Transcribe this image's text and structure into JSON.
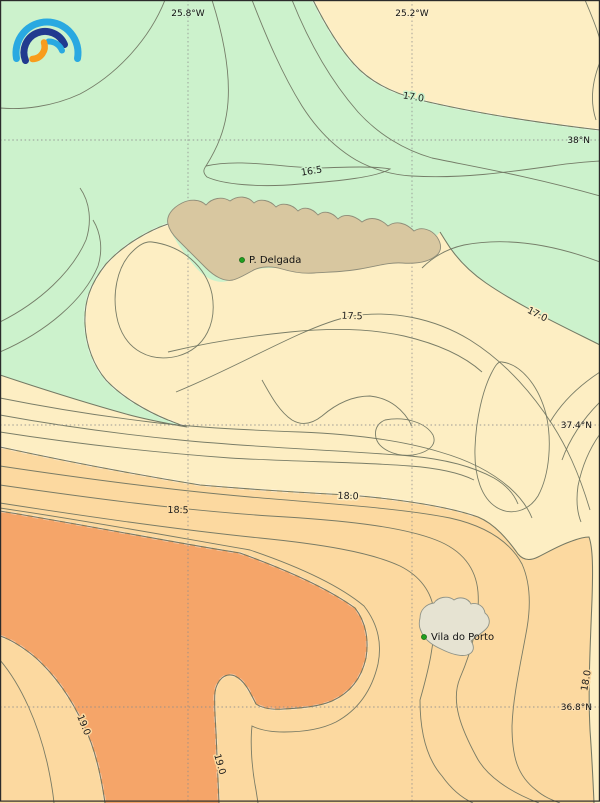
{
  "logo": {
    "icon": "rainbow-arcs-logo",
    "colors": {
      "outer_arc": "#29a9e1",
      "middle_arc": "#213a8f",
      "inner_arc": "#f89c1c"
    }
  },
  "grid": {
    "lon_labels": [
      "25.8°W",
      "25.2°W"
    ],
    "lat_labels": [
      "38°N",
      "37.4°N",
      "36.8°N"
    ]
  },
  "isotherms": {
    "labels": [
      "17.0",
      "16.5",
      "17.5",
      "17.0",
      "18.0",
      "18.5",
      "19.0",
      "19.0",
      "18.0"
    ],
    "labeled_values_degC": [
      16.5,
      17.0,
      17.5,
      18.0,
      18.5,
      19.0
    ]
  },
  "places": [
    {
      "name": "P. Delgada"
    },
    {
      "name": "Vila do Porto"
    }
  ],
  "colors": {
    "band_below_17": "#ccf2cc",
    "band_17_18": "#fdeec3",
    "band_18_19": "#fcd9a0",
    "band_above_19": "#f5a569",
    "island_fill": "#d8c7a0",
    "island_small_fill": "#e6e3d2",
    "contour_line": "#6e735f",
    "grid_line": "#8c8c8c",
    "marker_green": "#1f9e1f"
  }
}
